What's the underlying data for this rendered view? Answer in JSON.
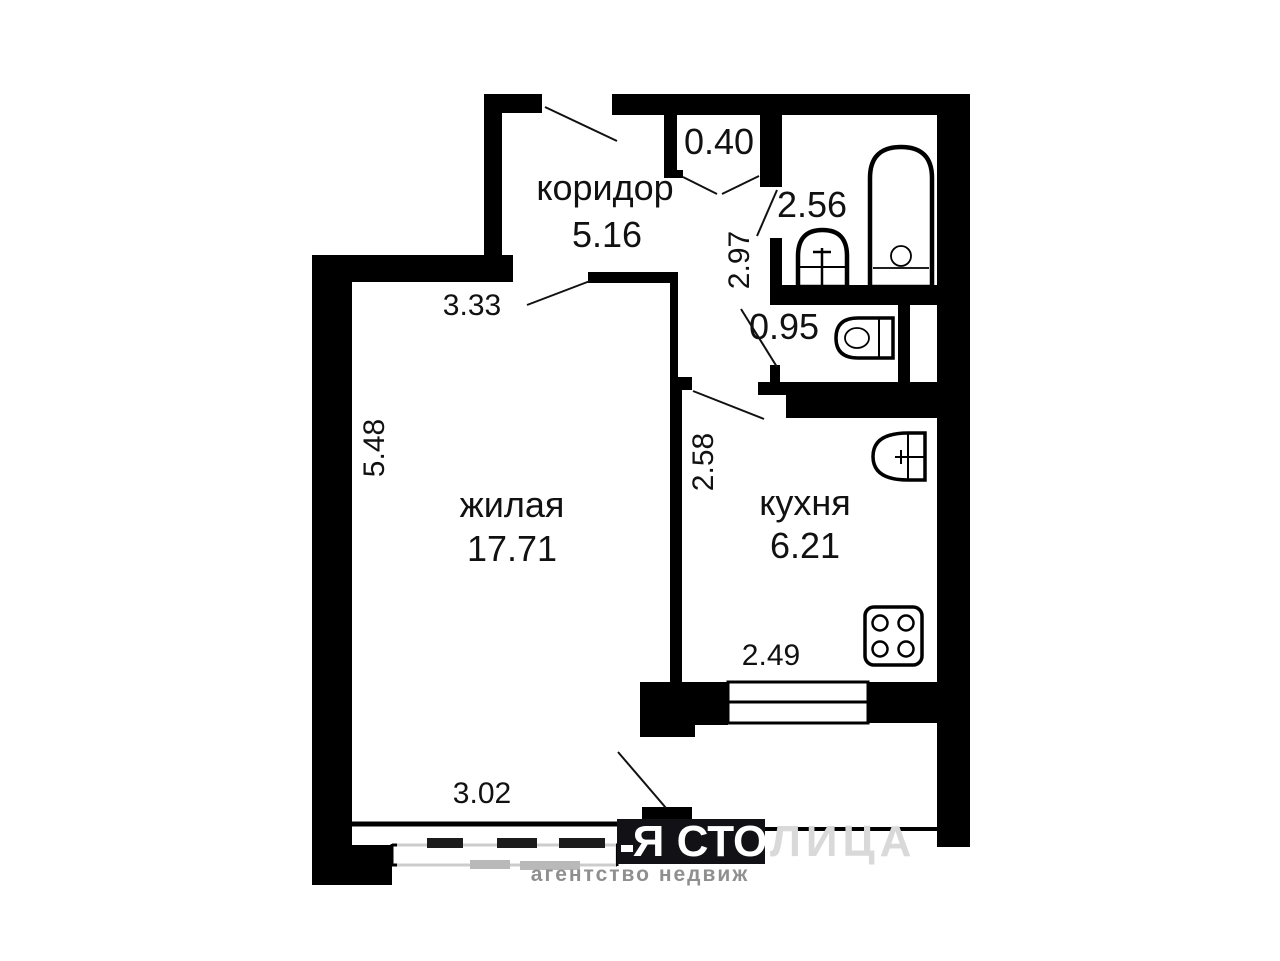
{
  "plan": {
    "type": "apartment-floor-plan",
    "rooms": {
      "corridor": {
        "name": "коридор",
        "area": "5.16"
      },
      "living": {
        "name": "жилая",
        "area": "17.71"
      },
      "kitchen": {
        "name": "кухня",
        "area": "6.21"
      },
      "bathroom": {
        "area": "2.56"
      },
      "toilet": {
        "area": "0.95"
      },
      "closet": {
        "area": "0.40"
      }
    },
    "dimensions": {
      "living_top_width": "3.33",
      "living_height": "5.48",
      "hall_height": "2.97",
      "kitchen_left_wall": "2.58",
      "kitchen_bottom_width": "2.49",
      "living_bottom_width": "3.02"
    },
    "fixtures": [
      "bathtub",
      "washbasin",
      "toilet",
      "kitchen-sink",
      "stove",
      "kitchen-window",
      "living-room-window"
    ],
    "colors": {
      "wall": "#000000",
      "background": "#ffffff",
      "text": "#111111",
      "watermark_box": "#121216",
      "watermark_text": "#ffffff",
      "watermark_faded": "#d9d9d9",
      "watermark_line2": "#8f8f8f"
    },
    "watermark": {
      "line1_strong": "Я СТО",
      "line1_faded": "ЛИЦА",
      "line2": "агентство недвиж"
    }
  }
}
